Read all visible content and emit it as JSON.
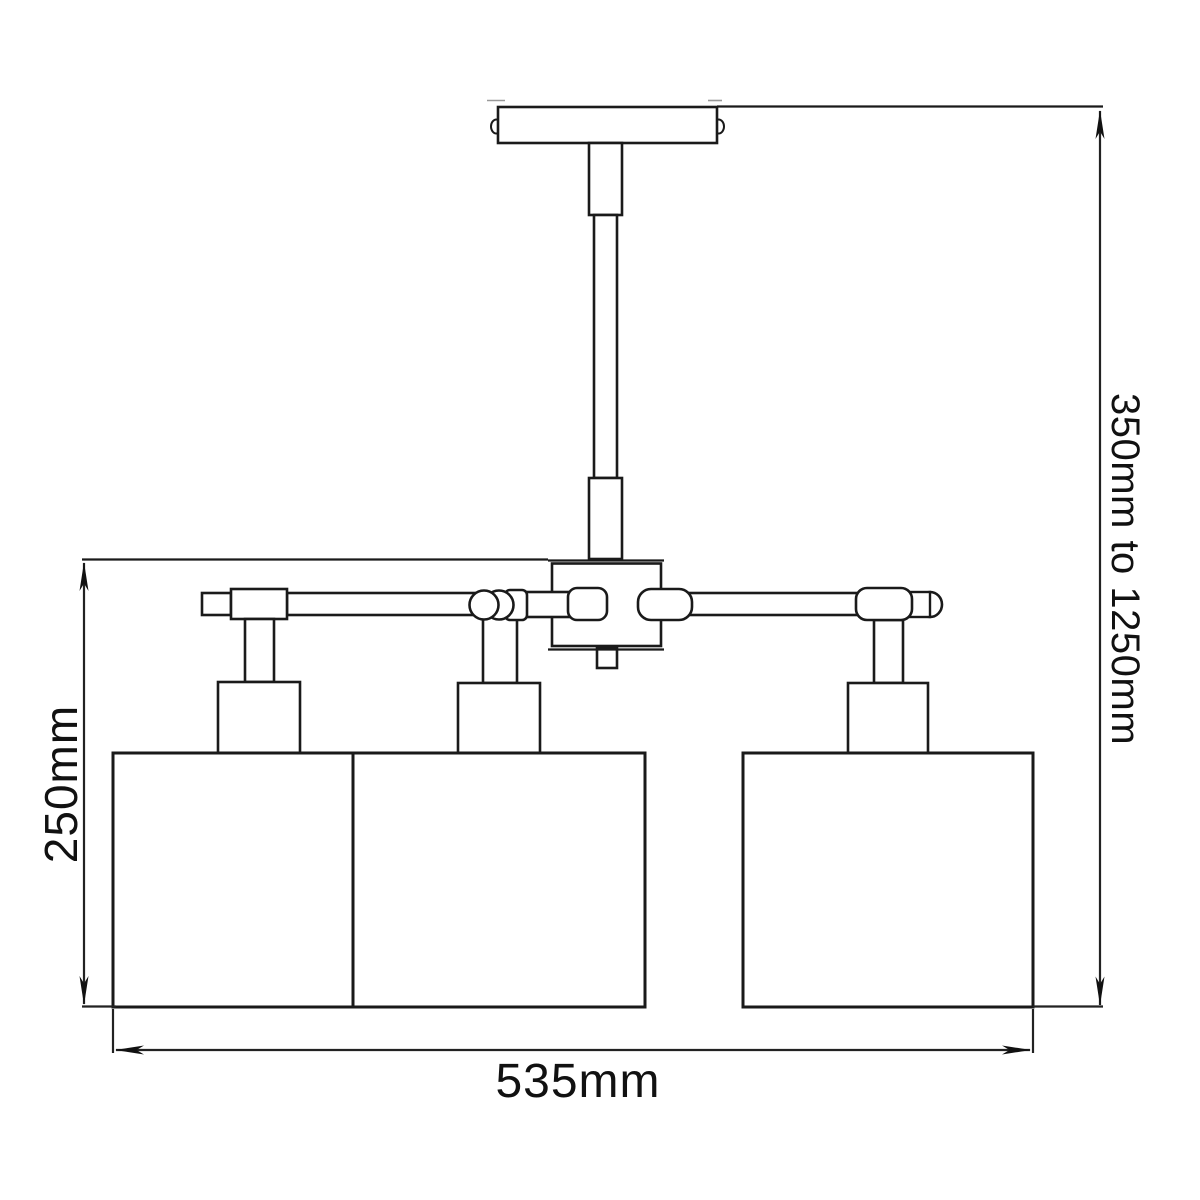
{
  "drawing": {
    "dimension_height_range": "350mm to 1250mm",
    "dimension_body_height": "250mm",
    "dimension_width": "535mm",
    "line_color": "#1a1a1a",
    "dimension_line_color": "#222222",
    "background_color": "#ffffff"
  }
}
